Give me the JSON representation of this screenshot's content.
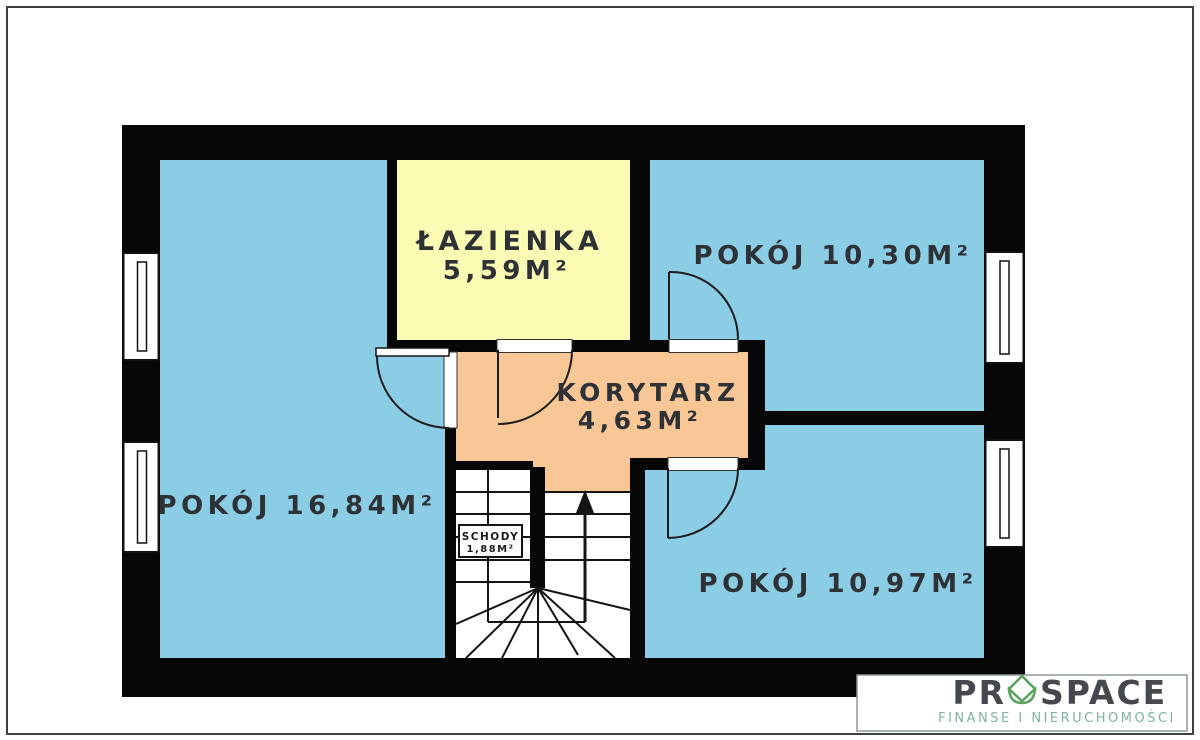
{
  "plan": {
    "rooms": {
      "bathroom": {
        "name": "ŁAZIENKA",
        "area": "5,59M²"
      },
      "room_top_right": {
        "label": "POKÓJ 10,30M²"
      },
      "corridor": {
        "name": "KORYTARZ",
        "area": "4,63M²"
      },
      "room_left": {
        "label": "POKÓJ 16,84M²"
      },
      "room_bottom_right": {
        "label": "POKÓJ 10,97M²"
      },
      "stairs": {
        "name": "SCHODY",
        "area": "1,88M²"
      }
    },
    "colors": {
      "room_blue": "#8BCDE4",
      "bathroom_yellow": "#FBFBB4",
      "corridor_orange": "#F9C795",
      "wall_black": "#070707",
      "label_dark": "#2E3237"
    }
  },
  "logo": {
    "brand_prefix": "PR",
    "brand_suffix": "SPACE",
    "tagline": "FINANSE I NIERUCHOMOŚCI",
    "colors": {
      "brand_text": "#45494D",
      "glyph_green": "#58A25C",
      "tagline_green": "#7EB49E"
    }
  }
}
